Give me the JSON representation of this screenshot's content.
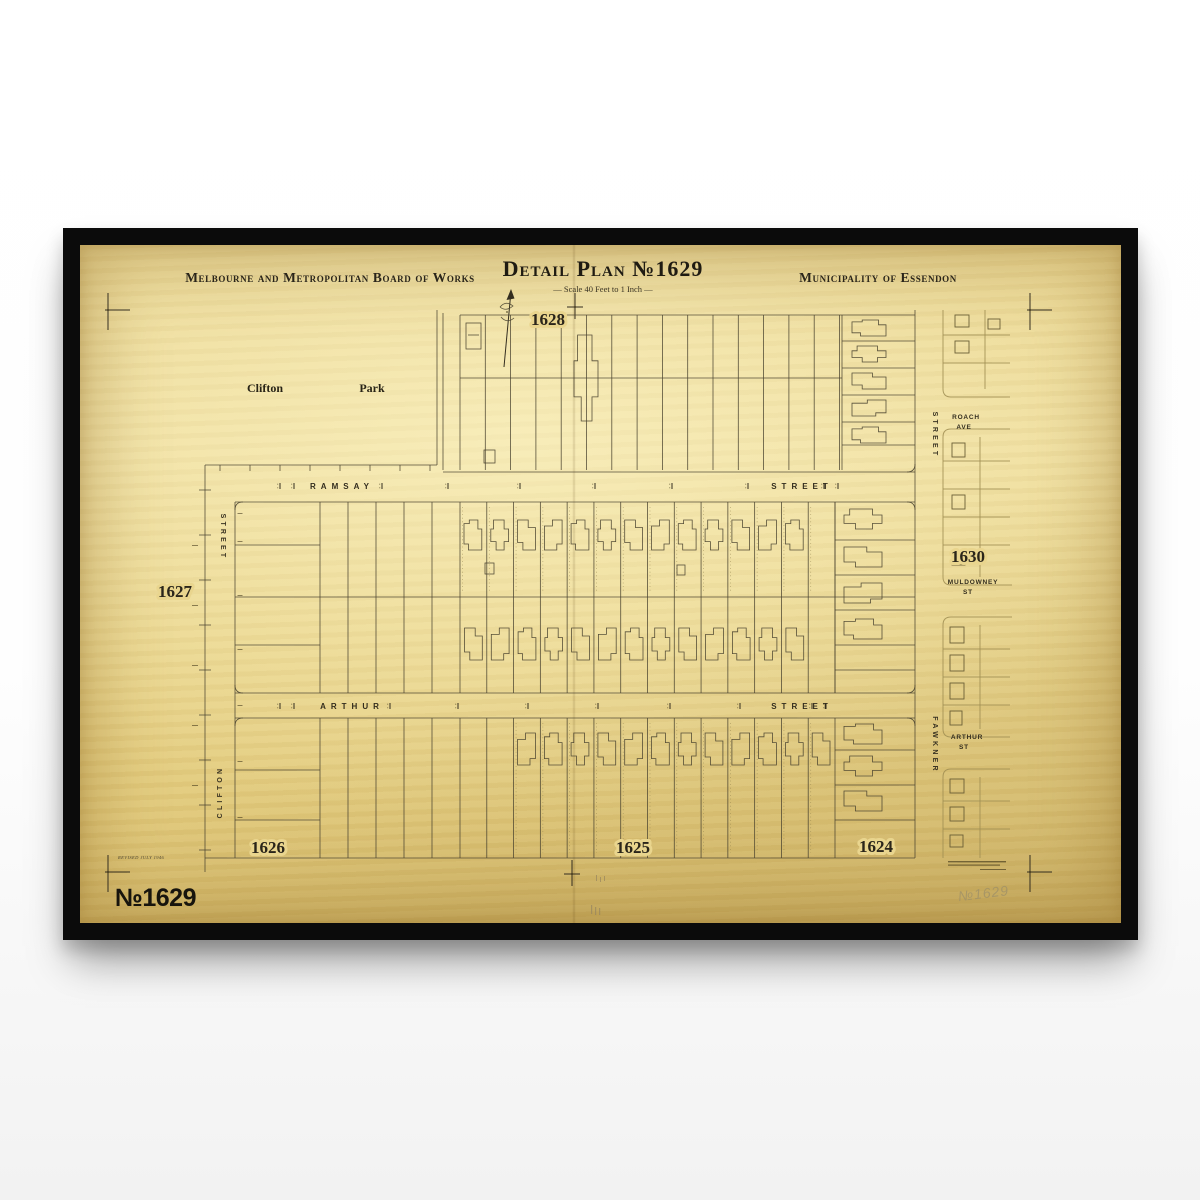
{
  "header": {
    "board": "Melbourne and Metropolitan Board of Works",
    "title": "Detail Plan №1629",
    "scale": "— Scale 40 Feet to 1 Inch —",
    "municipality": "Municipality of Essendon"
  },
  "plans": {
    "top": "1628",
    "left": "1627",
    "right": "1630",
    "bottom_left": "1626",
    "bottom_center": "1625",
    "bottom_right": "1624"
  },
  "park": {
    "word1": "Clifton",
    "word2": "Park"
  },
  "streets": {
    "ramsay_name": "RAMSAY",
    "ramsay_suffix": "STREET",
    "arthur_name": "ARTHUR",
    "arthur_suffix": "STREET",
    "left_top": "STREET",
    "left_bottom": "CLIFTON",
    "right_top": "STREET",
    "right_bottom": "FAWKNER",
    "roach_name": "ROACH",
    "roach_suffix": "AVE",
    "muldowney_name": "MULDOWNEY",
    "muldowney_suffix": "ST",
    "arthur_right_name": "ARTHUR",
    "arthur_right_suffix": "ST"
  },
  "footer": {
    "stamp": "№1629",
    "revised": "REVISED JULY 1946",
    "pencil": "№1629"
  },
  "colors": {
    "paper": "#e9d58e",
    "paper_edge": "#c9ae62",
    "ink": "#4a4330",
    "ink_strong": "#23201a",
    "faded_ink": "#a08e52",
    "pencil": "#a39366",
    "frame": "#0b0b0b",
    "wall": "#ffffff"
  }
}
